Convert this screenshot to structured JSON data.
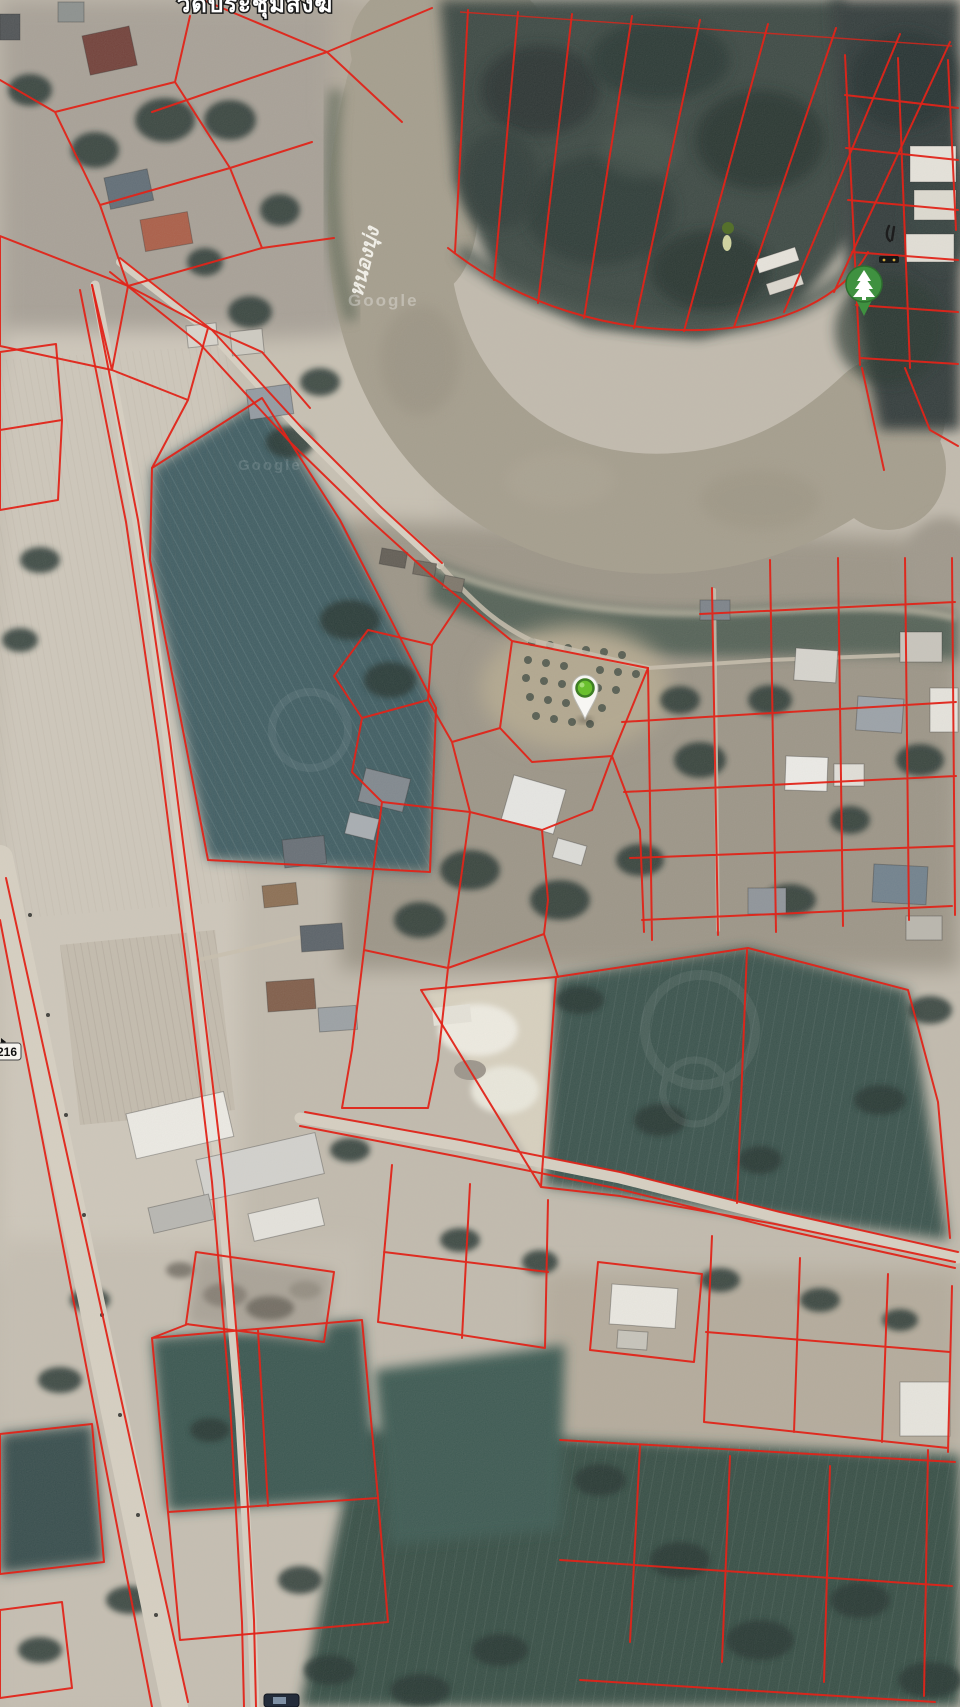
{
  "map": {
    "view_type": "satellite-with-cadastral-overlay",
    "labels": {
      "temple_name": "วัดประชุมสงฆ์",
      "water_name": "หนองบุ่ง",
      "route_number": "216",
      "imagery_watermark": "Google"
    },
    "markers": [
      {
        "name": "selected-location-pin",
        "style": "white teardrop pin with green dot",
        "dot_color": "#6abf2e",
        "ring_color": "#3e7d24"
      },
      {
        "name": "tree-poi-marker",
        "style": "green teardrop with white pine tree",
        "color": "#3f9140"
      }
    ],
    "colors": {
      "parcel_line": "#e02419",
      "water": "#a49d8c",
      "field_teal": "#3b5a60",
      "field_pale": "#cdc6b9",
      "forest": "#2f3d39",
      "crop_dark": "#36504a",
      "road": "#d8d1c3"
    }
  }
}
